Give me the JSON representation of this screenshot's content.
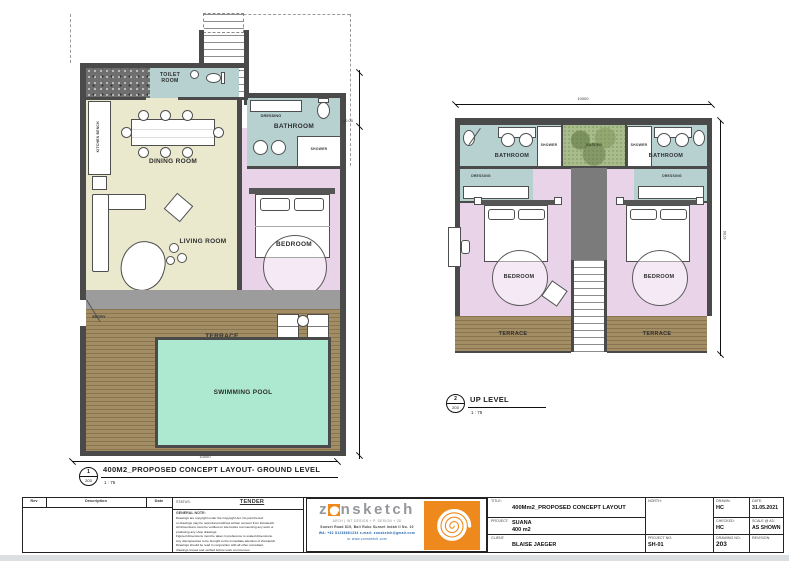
{
  "colors": {
    "wall": "#4a4a4a",
    "floor_living": "#eae8cd",
    "floor_bedroom": "#e9d3e9",
    "floor_wet": "#b7d1d1",
    "floor_terrace": "#a28d64",
    "pool": "#ade8d0",
    "garden": "#a9bc8c",
    "accent_orange": "#ee8a1d"
  },
  "ground": {
    "callout_num": "1",
    "callout_sheet": "203",
    "title": "400M2_PROPOSED CONCEPT LAYOUT- GROUND LEVEL",
    "scale": "1 : 75",
    "rooms": {
      "toilet": "TOILET ROOM",
      "dining": "DINING ROOM",
      "living": "LIVING ROOM",
      "bedroom": "BEDROOM",
      "bathroom": "BATHROOM",
      "dressing": "DRESSING",
      "shower": "SHOWER",
      "kitchen_bench": "KITCHEN BENCH",
      "terrace": "TERRACE",
      "pool": "SWIMMING POOL",
      "entry": "ENTRY"
    },
    "dim_width": "10000",
    "level_mark": "±0.00"
  },
  "up": {
    "callout_num": "2",
    "callout_sheet": "203",
    "title": "UP LEVEL",
    "scale": "1 : 75",
    "rooms": {
      "bathroom_left": "BATHROOM",
      "bathroom_right": "BATHROOM",
      "shower_left": "SHOWER",
      "shower_right": "SHOWER",
      "garden": "GARDEN",
      "dressing_left": "DRESSING",
      "dressing_right": "DRESSING",
      "bedroom_left": "BEDROOM",
      "bedroom_right": "BEDROOM",
      "terrace_left": "TERRACE",
      "terrace_right": "TERRACE"
    },
    "dim_width": "10000",
    "dim_height": "9700"
  },
  "titleblock": {
    "rev_headers": [
      "Rev",
      "Description",
      "Date"
    ],
    "status_label": "STATUS:",
    "status_value": "TENDER",
    "note_label": "GENERAL NOTE:",
    "note_lines": [
      "Drawings are copyright under the Copyright Act. No part thereof",
      "or drawings may be reproduced without written consent from Zonsketch.",
      "All dimensions must be verified on site before commencing any work or",
      "producing any shop drawings.",
      "Figured dimensions must be taken in preference to scaled dimensions.",
      "Any discrepancies to be brought to the immediate attention of Zonsketch.",
      "Drawings should be read in conjunction with all other consultant",
      "drawings issued and verified before work commences."
    ],
    "logo": {
      "word_start": "z",
      "word_end": "nsketch",
      "tagline": "ARCH | INT DESIGN + P. DESIGN + 3D",
      "address": "Sunset Road 819, Bali Ruko Sunset Indah II No. 10",
      "contact": "WA: +62 81236661234  e-mail: zonsketch@gmail.com",
      "web": "or www.zonsketch.com"
    },
    "title_label": "TITLE:",
    "title_value": "400Mm2_PROPOSED CONCEPT LAYOUT",
    "project_label": "PROJECT:",
    "project_name": "SUANA",
    "project_area": "400 m2",
    "client_label": "CLIENT:",
    "client_value": "BLAISE JAEGER",
    "north_label": "NORTH:",
    "drawn_label": "DRAWN:",
    "drawn_value": "HC",
    "date_label": "DATE:",
    "date_value": "31.05.2021",
    "checked_label": "CHECKED:",
    "checked_value": "HC",
    "scale_label": "SCALE @ A3:",
    "scale_value": "AS SHOWN",
    "project_no_label": "PROJECT NO:",
    "project_no_value": "SH-01",
    "drawing_no_label": "DRAWING NO:",
    "drawing_no_value": "203",
    "revision_label": "REVISION:"
  }
}
